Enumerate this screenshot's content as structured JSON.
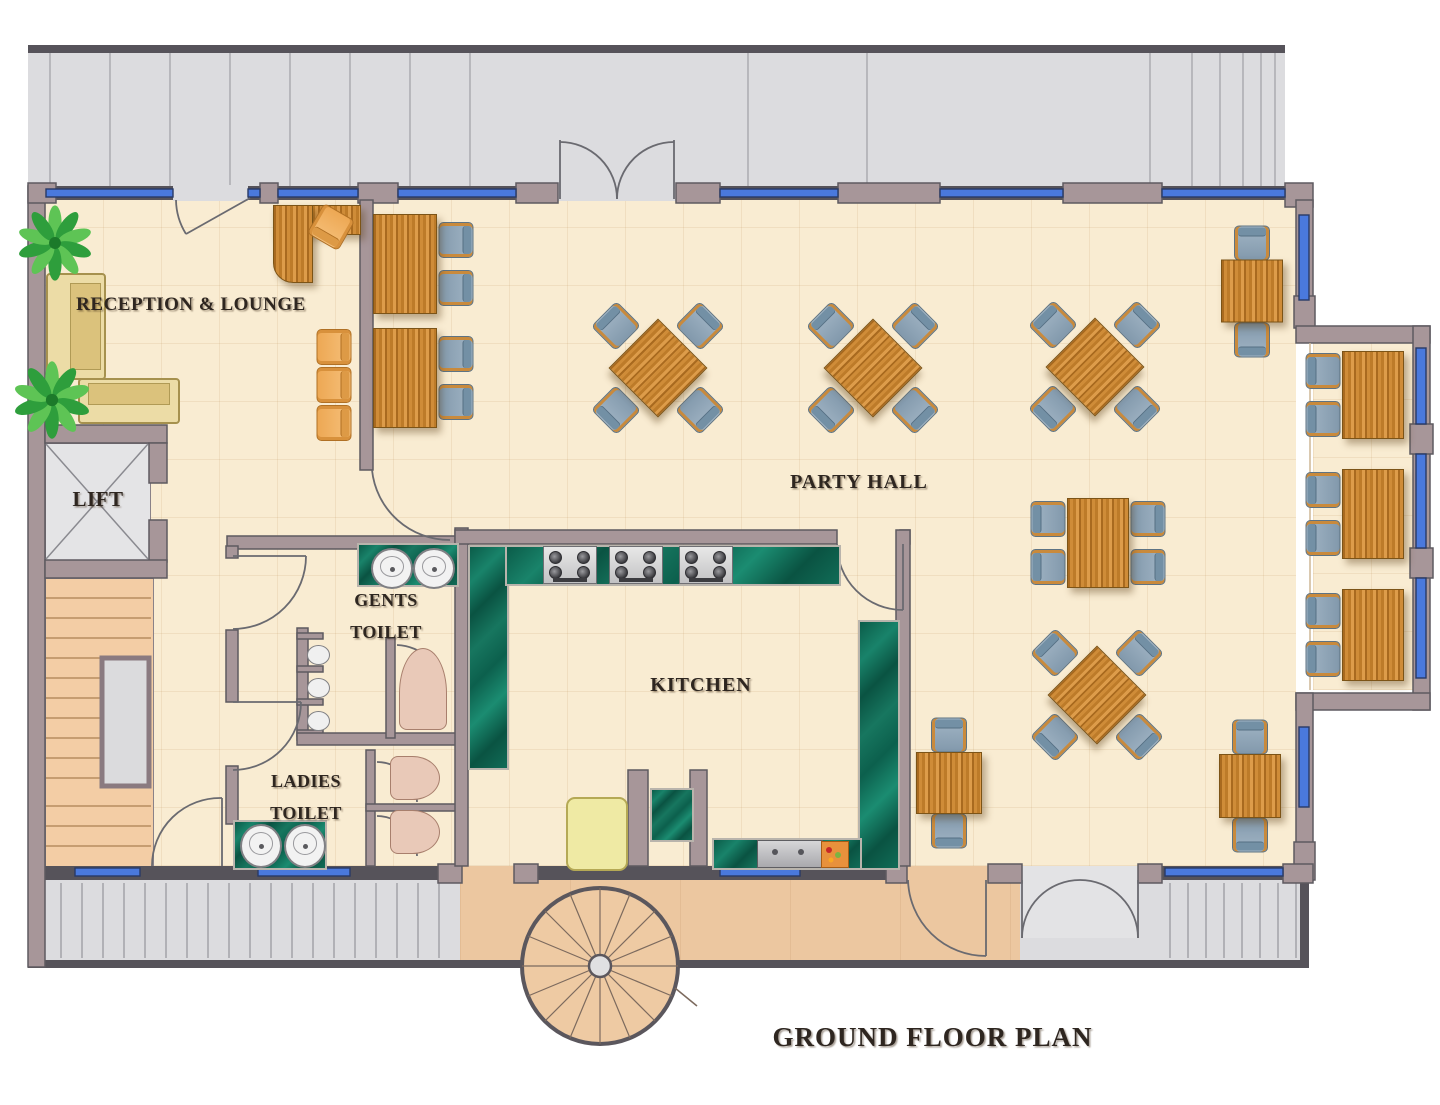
{
  "title": "GROUND FLOOR PLAN",
  "rooms": {
    "reception": "RECEPTION & LOUNGE",
    "lift": "LIFT",
    "gents_toilet": "GENTS\nTOILET",
    "ladies_toilet": "LADIES\nTOILET",
    "kitchen": "KITCHEN",
    "party_hall": "PARTY HALL"
  },
  "palette": {
    "wall": "#a79699",
    "wall_dark": "#56535a",
    "window_blue": "#4a79dd",
    "floor_cream": "#f9ecd2",
    "terrace_grey": "#dcdcdf",
    "walkway_peach": "#ecc7a0",
    "stairs_peach": "#f3cda5",
    "counter_green": "#0f6b56",
    "wood": "#cf8c38",
    "chair_grey": "#93a7b8",
    "chair_orange": "#f3b469",
    "sofa_tan": "#ecdca6",
    "toilet_pink": "#e9c9b8",
    "label_ink": "#2e2620"
  },
  "furniture": {
    "diamond_tables": [
      {
        "x": 658,
        "y": 368
      },
      {
        "x": 873,
        "y": 368
      },
      {
        "x": 1095,
        "y": 367
      },
      {
        "x": 1097,
        "y": 695
      }
    ],
    "side_tables": [
      {
        "x": 405,
        "y": 264,
        "w": 62,
        "h": 98,
        "sides": [
          "right"
        ]
      },
      {
        "x": 405,
        "y": 378,
        "w": 62,
        "h": 98,
        "sides": [
          "right"
        ]
      },
      {
        "x": 1373,
        "y": 395,
        "w": 60,
        "h": 86,
        "sides": [
          "left"
        ]
      },
      {
        "x": 1373,
        "y": 514,
        "w": 60,
        "h": 88,
        "sides": [
          "left"
        ]
      },
      {
        "x": 1373,
        "y": 635,
        "w": 60,
        "h": 90,
        "sides": [
          "left"
        ]
      },
      {
        "x": 1098,
        "y": 543,
        "w": 60,
        "h": 88,
        "sides": [
          "left",
          "right"
        ]
      }
    ],
    "duo_tables": [
      {
        "x": 949,
        "y": 783,
        "w": 64,
        "h": 60
      },
      {
        "x": 1250,
        "y": 786,
        "w": 60,
        "h": 62
      },
      {
        "x": 1252,
        "y": 291,
        "w": 60,
        "h": 61
      }
    ],
    "reception": {
      "desk": {
        "x": 273,
        "y": 205,
        "bar_w": 86,
        "bar_h": 28,
        "leg_w": 38,
        "leg_h": 76
      },
      "desk_chair": {
        "x": 331,
        "y": 227,
        "rot": 210
      },
      "guest_chairs": [
        {
          "x": 334,
          "y": 347,
          "rot": 90
        },
        {
          "x": 334,
          "y": 385,
          "rot": 90
        },
        {
          "x": 334,
          "y": 423,
          "rot": 90
        }
      ],
      "sofas": [
        {
          "x": 46,
          "y": 273,
          "w": 56,
          "h": 103,
          "dir": "v"
        },
        {
          "x": 78,
          "y": 378,
          "w": 98,
          "h": 42,
          "dir": "h"
        }
      ],
      "plants": [
        {
          "x": 55,
          "y": 243,
          "s": 33
        },
        {
          "x": 52,
          "y": 400,
          "s": 34
        }
      ]
    }
  },
  "fixtures": {
    "counters": [
      {
        "x": 468,
        "y": 545,
        "w": 37,
        "h": 221
      },
      {
        "x": 505,
        "y": 545,
        "w": 332,
        "h": 37
      },
      {
        "x": 858,
        "y": 620,
        "w": 38,
        "h": 246
      },
      {
        "x": 712,
        "y": 838,
        "w": 146,
        "h": 28
      },
      {
        "x": 650,
        "y": 788,
        "w": 40,
        "h": 50
      },
      {
        "x": 357,
        "y": 543,
        "w": 98,
        "h": 40
      },
      {
        "x": 233,
        "y": 820,
        "w": 90,
        "h": 46
      }
    ],
    "stoves": [
      {
        "x": 543,
        "y": 546,
        "w": 52,
        "h": 36
      },
      {
        "x": 609,
        "y": 546,
        "w": 52,
        "h": 36
      },
      {
        "x": 679,
        "y": 546,
        "w": 52,
        "h": 36
      }
    ],
    "sink": {
      "x": 757,
      "y": 840,
      "w": 64,
      "h": 26
    },
    "board": {
      "x": 821,
      "y": 841,
      "w": 26,
      "h": 25
    },
    "fridge": {
      "x": 566,
      "y": 797,
      "w": 58,
      "h": 70
    },
    "basins": [
      {
        "x": 371,
        "y": 548,
        "w": 38,
        "h": 37
      },
      {
        "x": 413,
        "y": 548,
        "w": 38,
        "h": 37
      },
      {
        "x": 240,
        "y": 824,
        "w": 38,
        "h": 40
      },
      {
        "x": 284,
        "y": 824,
        "w": 38,
        "h": 40
      }
    ],
    "urinals": [
      {
        "x": 307,
        "y": 645,
        "w": 21,
        "h": 18
      },
      {
        "x": 307,
        "y": 678,
        "w": 21,
        "h": 18
      },
      {
        "x": 307,
        "y": 711,
        "w": 21,
        "h": 18
      }
    ],
    "toilets": [
      {
        "x": 399,
        "y": 648,
        "w": 46,
        "h": 80,
        "o": "v"
      },
      {
        "x": 390,
        "y": 756,
        "w": 48,
        "h": 42,
        "o": "h"
      },
      {
        "x": 390,
        "y": 810,
        "w": 48,
        "h": 42,
        "o": "h"
      }
    ]
  }
}
